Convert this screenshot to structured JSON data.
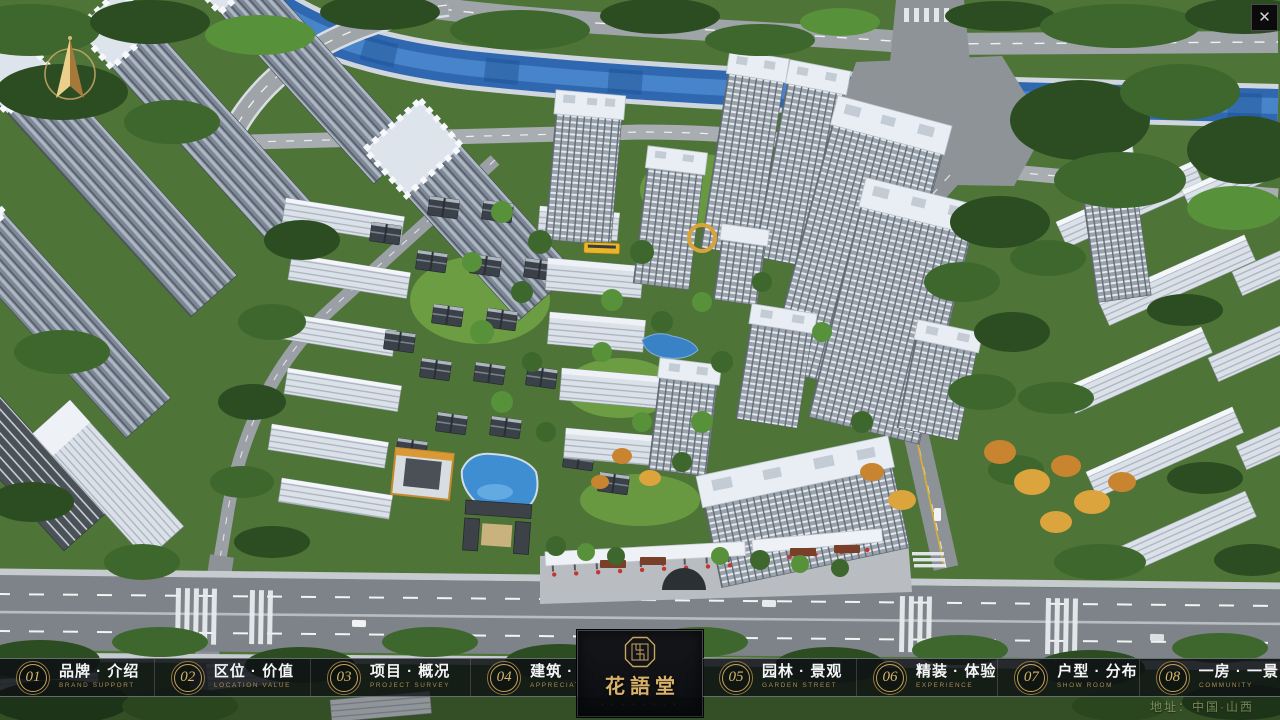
{
  "window": {
    "close_label": "✕"
  },
  "nav": {
    "items": [
      {
        "number": "01",
        "label": "品牌 · 介绍",
        "sublabel": "BRAND SUPPORT"
      },
      {
        "number": "02",
        "label": "区位 · 价值",
        "sublabel": "LOCATION VALUE"
      },
      {
        "number": "03",
        "label": "项目 · 概况",
        "sublabel": "PROJECT SURVEY"
      },
      {
        "number": "04",
        "label": "建筑 · 鉴赏",
        "sublabel": "APPRECIATION"
      },
      {
        "number": "05",
        "label": "园林 · 景观",
        "sublabel": "GARDEN STREET"
      },
      {
        "number": "06",
        "label": "精装 · 体验",
        "sublabel": "EXPERIENCE"
      },
      {
        "number": "07",
        "label": "户型 · 分布",
        "sublabel": "SHOW ROOM"
      },
      {
        "number": "08",
        "label": "一房 · 一景",
        "sublabel": "COMMUNITY"
      }
    ]
  },
  "logo": {
    "title": "花語堂",
    "tagline": "· · · · · · · ·"
  },
  "footer": {
    "address": "地址：中国·山西"
  },
  "colors": {
    "gold": "#c8a45c",
    "panel": "#101216",
    "river": "#2f68b0",
    "flag_red": "#c2382e"
  }
}
